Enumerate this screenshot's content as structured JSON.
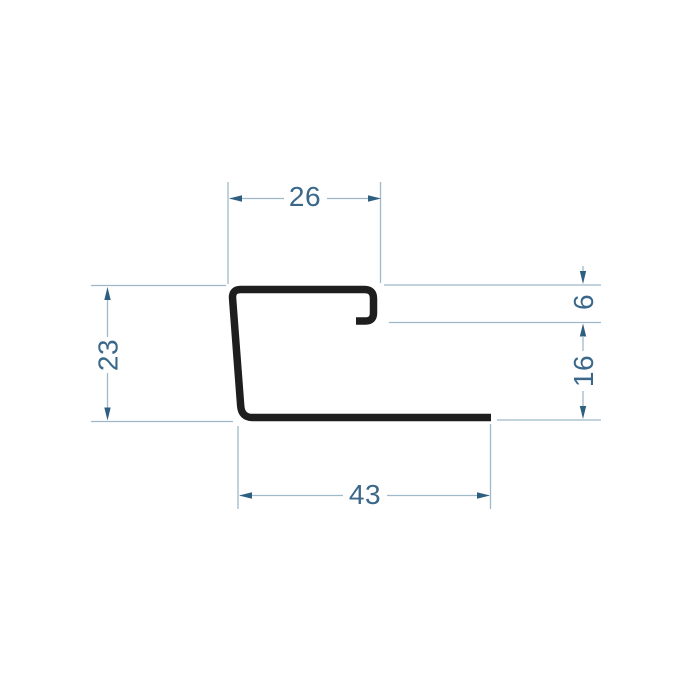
{
  "page": {
    "background": "#ffffff",
    "description": "Technical cross-section drawing of a J-shaped sheet-metal edge profile with five dimensions"
  },
  "drawing": {
    "colors": {
      "profile": "#1e1e1e",
      "dim_line": "#9fb9c9",
      "dim_arrow": "#2f5f80",
      "dim_text": "#3a688a"
    },
    "dimensions": {
      "top_width": "26",
      "left_height": "23",
      "lip_drop": "6",
      "right_lower_height": "16",
      "bottom_width": "43"
    }
  }
}
